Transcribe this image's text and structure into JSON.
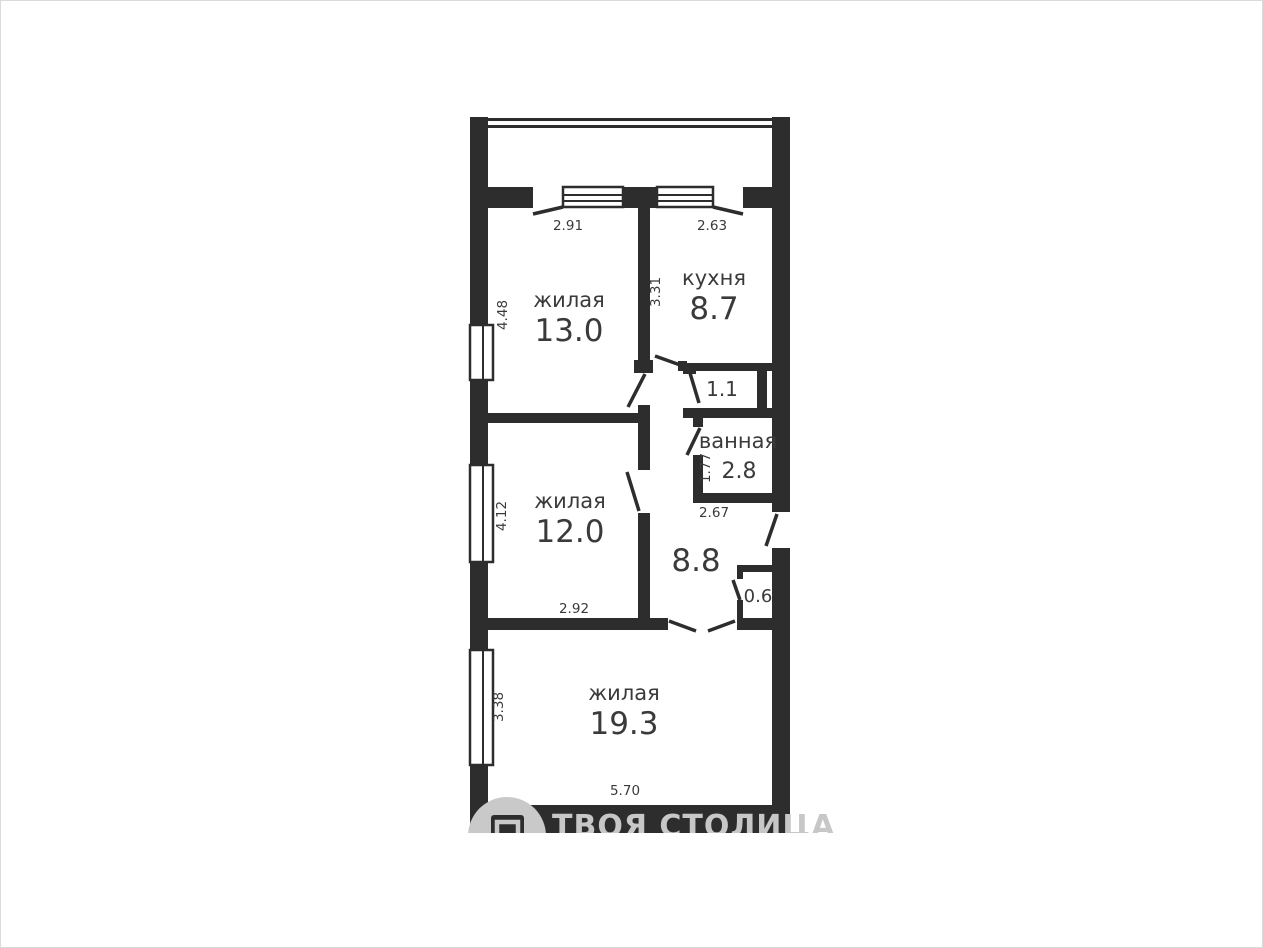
{
  "colors": {
    "wall": "#2d2d2d",
    "text": "#3a3a3a",
    "watermark": "#c7c7c7",
    "background": "#ffffff"
  },
  "rooms": {
    "living13": {
      "label": "жилая",
      "area": "13.0",
      "dim_top": "2.91",
      "dim_left": "4.48"
    },
    "kitchen": {
      "label": "кухня",
      "area": "8.7",
      "dim_top": "2.63",
      "dim_left": "3.31"
    },
    "closet": {
      "area": "1.1"
    },
    "bathroom": {
      "label": "ванная",
      "area": "2.8",
      "dim_bottom": "2.67",
      "dim_left": "1.77"
    },
    "living12": {
      "label": "жилая",
      "area": "12.0",
      "dim_bottom": "2.92",
      "dim_left": "4.12"
    },
    "hall": {
      "area": "8.8"
    },
    "storage": {
      "area": "0.6"
    },
    "living19": {
      "label": "жилая",
      "area": "19.3",
      "dim_bottom": "5.70",
      "dim_left": "3.38"
    }
  },
  "watermark": {
    "brand": "ТВОЯ СТОЛИЦА"
  }
}
